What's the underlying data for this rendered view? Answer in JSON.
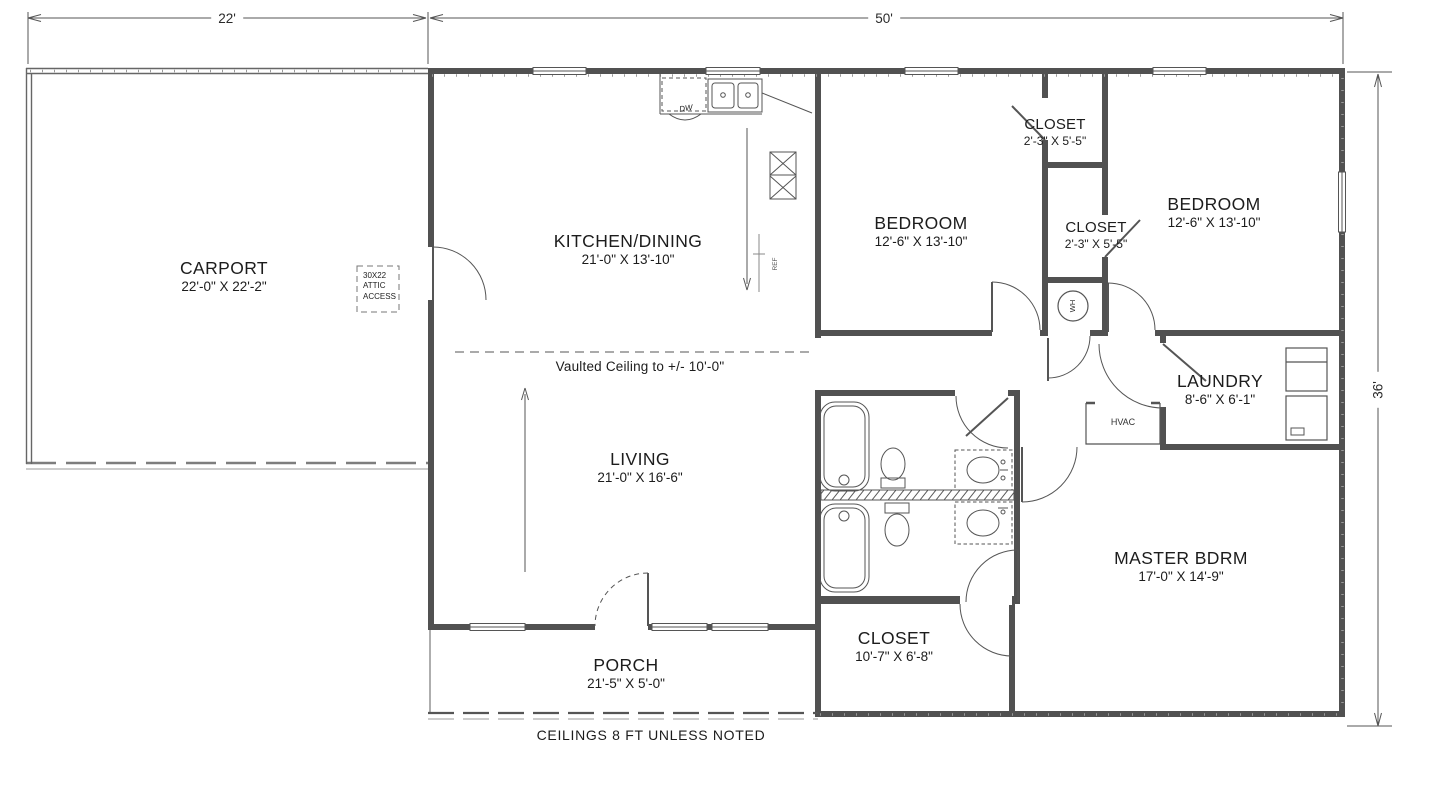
{
  "drawing": {
    "type": "floor-plan",
    "vaulted_note": "Vaulted Ceiling to +/-  10'-0\"",
    "footer_note": "CEILINGS 8 FT UNLESS NOTED"
  },
  "dimensions": {
    "width_left": "22'",
    "width_right": "50'",
    "height_right": "36'"
  },
  "rooms": [
    {
      "name": "CARPORT",
      "size": "22'-0\" X 22'-2\""
    },
    {
      "name": "KITCHEN/DINING",
      "size": "21'-0\" X 13'-10\""
    },
    {
      "name": "BEDROOM",
      "size": "12'-6\" X 13'-10\""
    },
    {
      "name": "CLOSET",
      "size": "2'-3\" X 5'-5\""
    },
    {
      "name": "CLOSET",
      "size": "2'-3\" X 5'-5\""
    },
    {
      "name": "BEDROOM",
      "size": "12'-6\" X 13'-10\""
    },
    {
      "name": "LAUNDRY",
      "size": "8'-6\" X 6'-1\""
    },
    {
      "name": "LIVING",
      "size": "21'-0\" X 16'-6\""
    },
    {
      "name": "MASTER BDRM",
      "size": "17'-0\" X 14'-9\""
    },
    {
      "name": "CLOSET",
      "size": "10'-7\" X 6'-8\""
    },
    {
      "name": "PORCH",
      "size": "21'-5\" X 5'-0\""
    }
  ],
  "fixtures": {
    "water_heater": "WH",
    "hvac": "HVAC",
    "dishwasher": "DW",
    "refrigerator": "REF",
    "attic_access": "30X22\nATTIC\nACCESS"
  },
  "colors": {
    "wall": "#515151",
    "thin_line": "#666666",
    "text": "#1c1c1c"
  }
}
